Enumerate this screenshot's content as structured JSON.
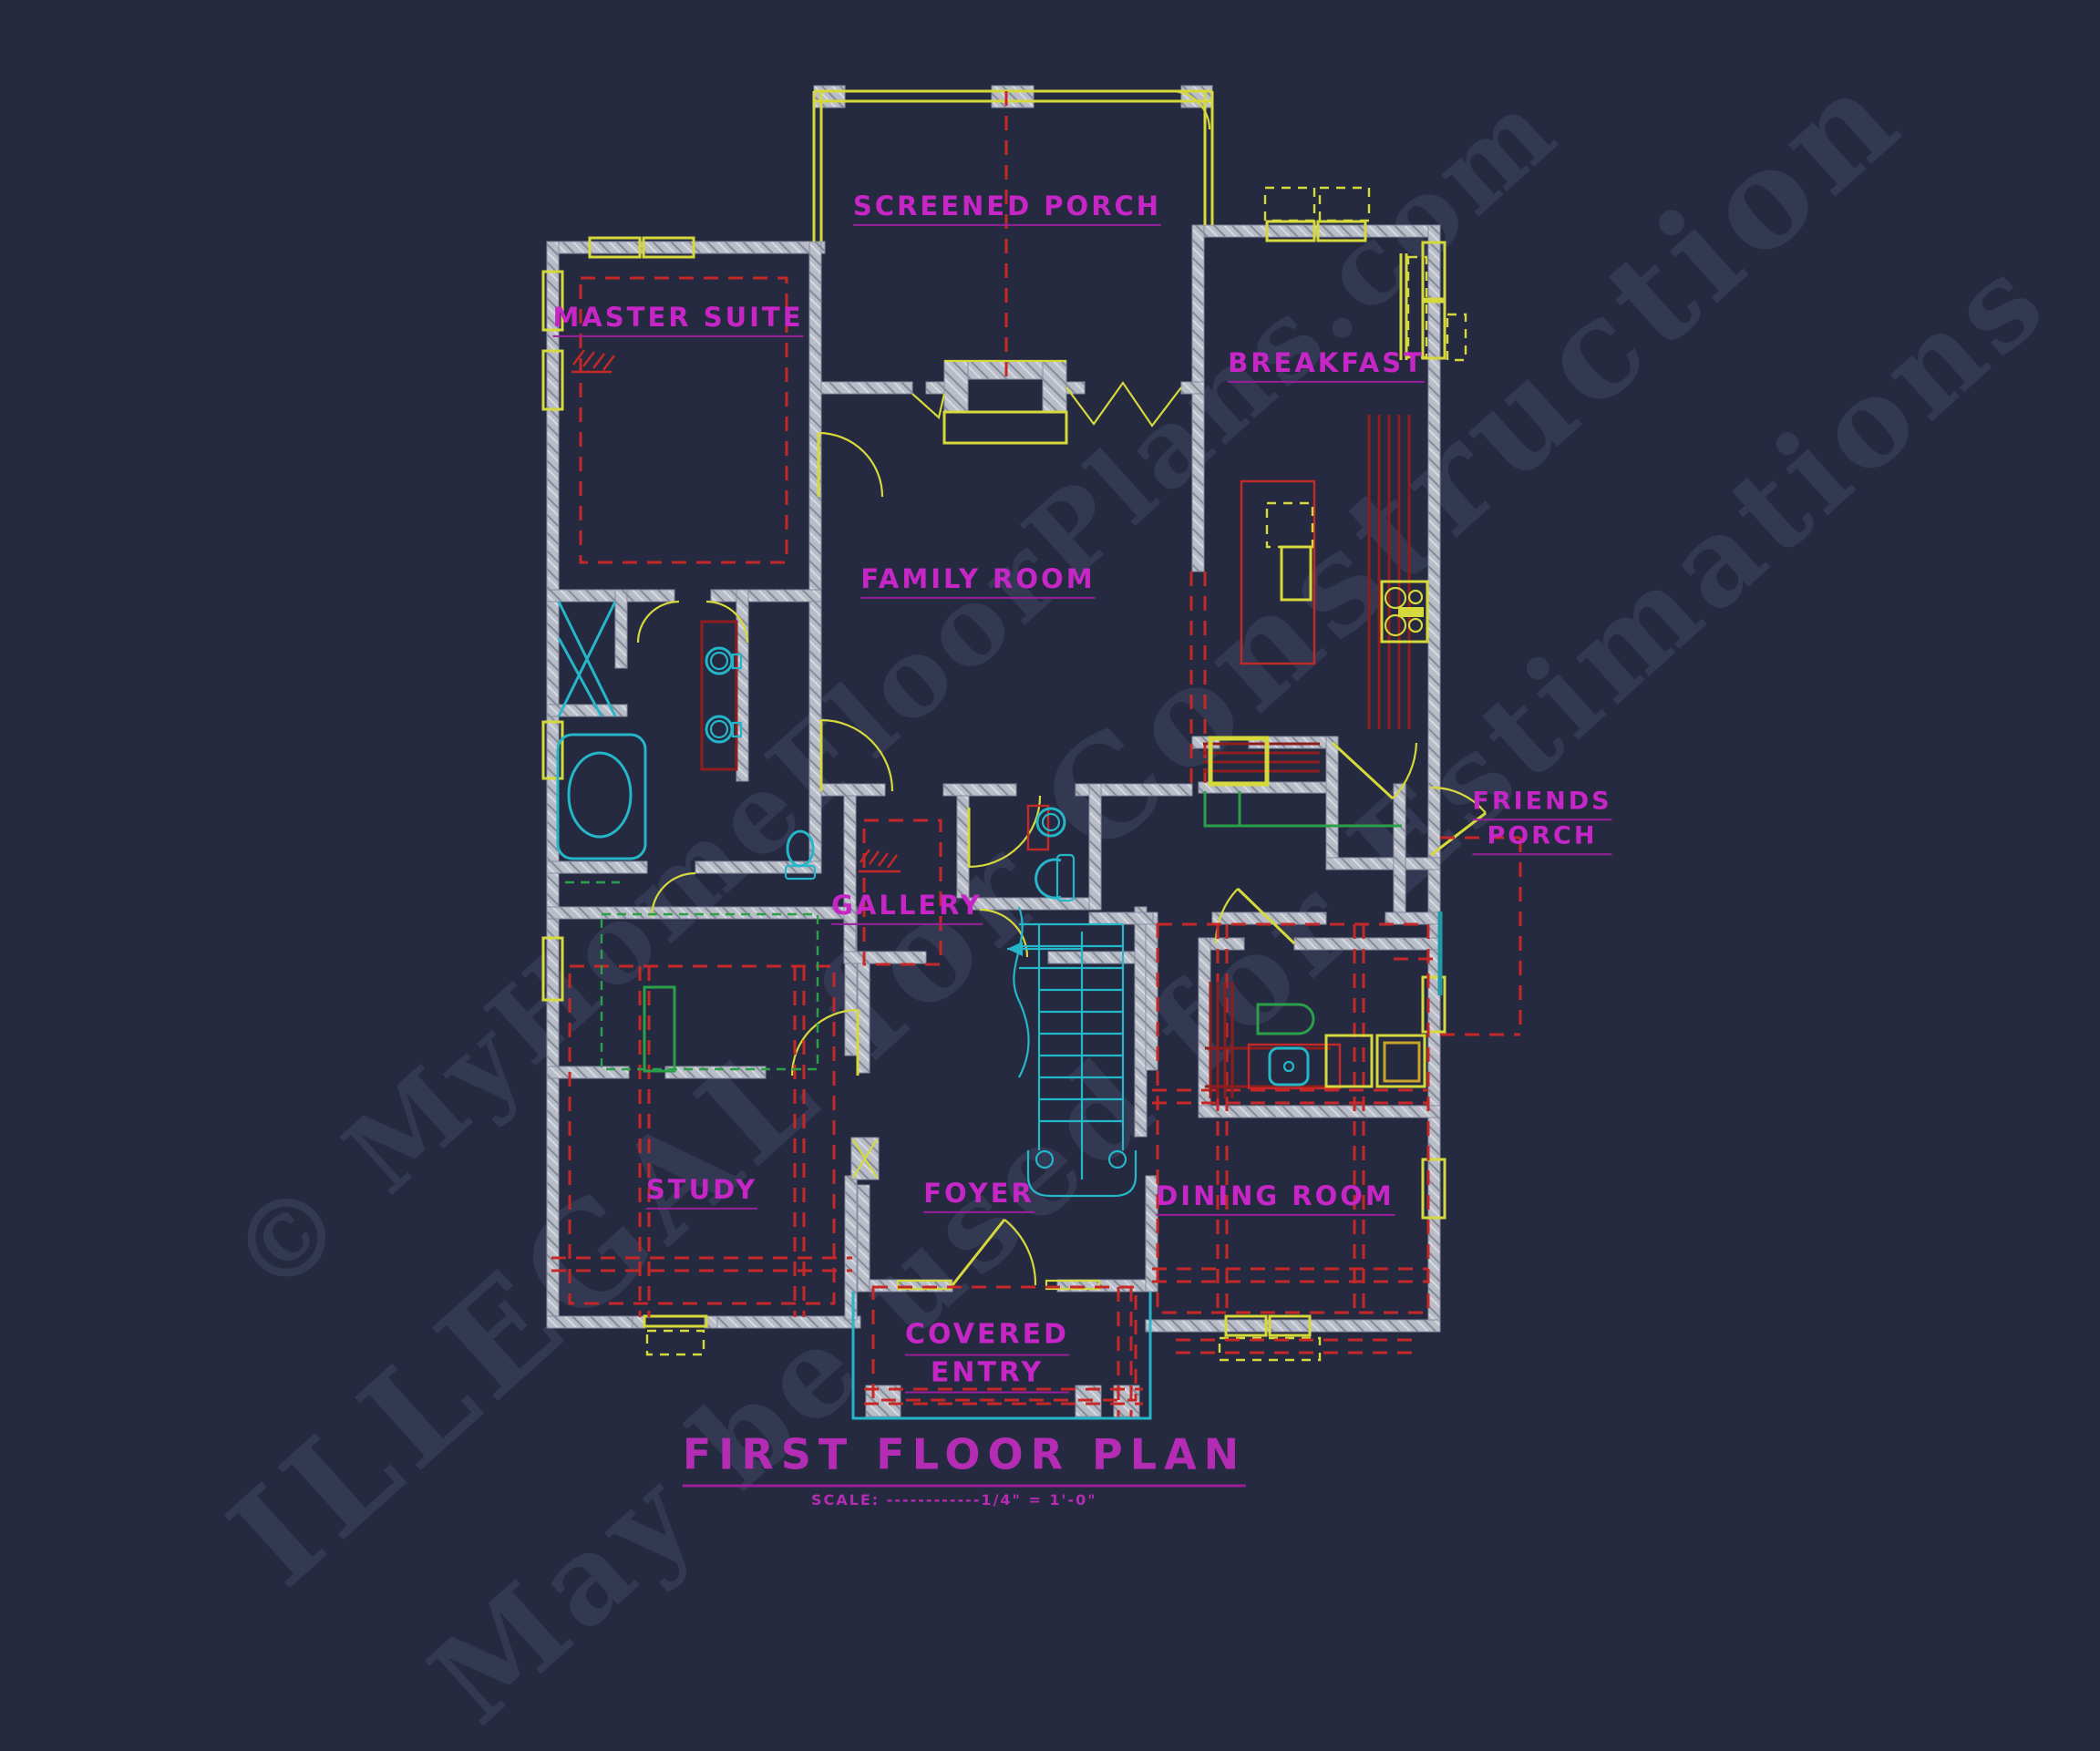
{
  "drawing": {
    "title": "FIRST FLOOR PLAN",
    "scale_note": "SCALE: ------------1/4\" = 1'-0\"",
    "rooms": {
      "screened_porch": "SCREENED PORCH",
      "master_suite": "MASTER SUITE",
      "breakfast": "BREAKFAST",
      "family_room": "FAMILY ROOM",
      "gallery": "GALLERY",
      "friends_porch_line1": "FRIENDS",
      "friends_porch_line2": "PORCH",
      "study": "STUDY",
      "foyer": "FOYER",
      "dining_room": "DINING ROOM",
      "covered_entry_line1": "COVERED",
      "covered_entry_line2": "ENTRY"
    },
    "watermarks": {
      "brand": "© MyHomeFloorPlans.com",
      "notice1": "ILLEGAL for Construction",
      "notice2": "May be used for Estimations"
    },
    "colors": {
      "background": "#252a40",
      "walls": "#b9bdc7",
      "room_labels": "#c626c6",
      "windows_doors": "#d6d93c",
      "plumbing_fixtures": "#25b6c9",
      "ceiling_dashed": "#c62828",
      "cabinetry": "#8f1d1d",
      "closets": "#2aa148",
      "watermark": "#5a6180"
    }
  }
}
